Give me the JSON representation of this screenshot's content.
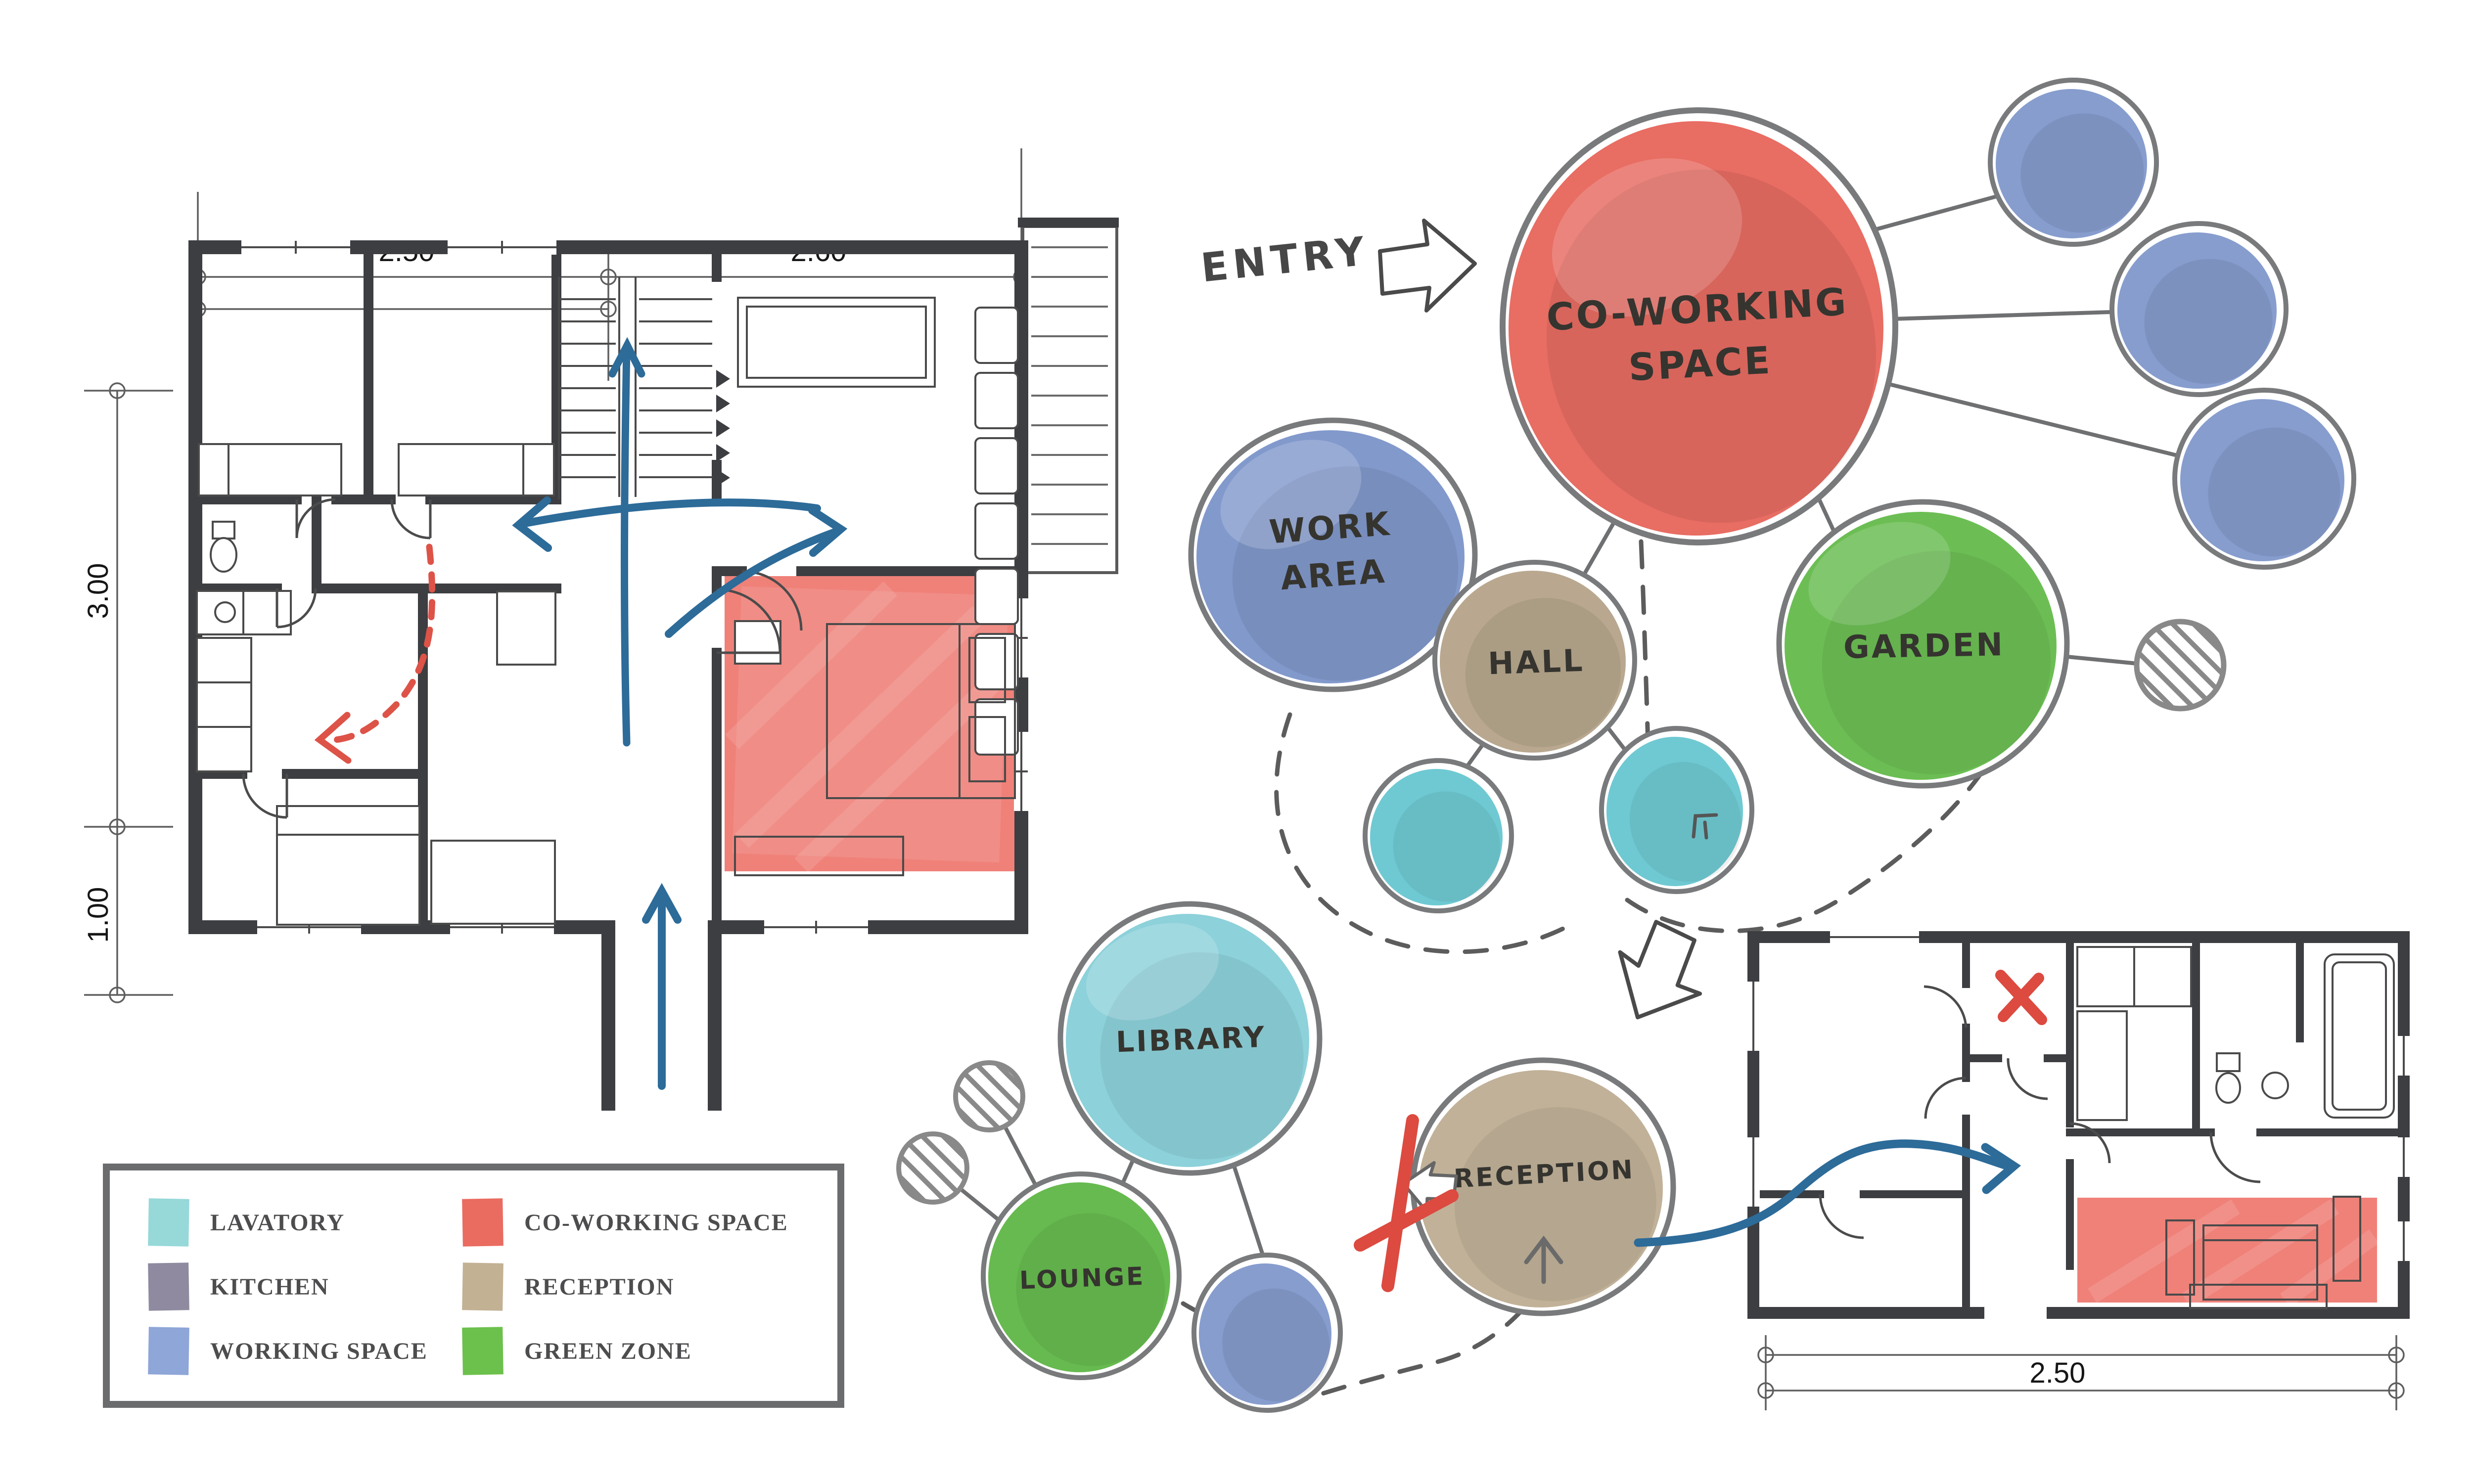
{
  "diagram": {
    "entry_label": "ENTRY",
    "colors": {
      "wall": "#3c3e41",
      "blue_arrow": "#2d6b99",
      "red_accent": "#dd5348",
      "bubble_ring": "#797a7c",
      "connector": "#6f7072",
      "dashed_line": "#5c5c5c"
    }
  },
  "legend": {
    "items": [
      {
        "label": "LAVATORY",
        "color": "#97d8d9"
      },
      {
        "label": "KITCHEN",
        "color": "#8f8aa0"
      },
      {
        "label": "WORKING SPACE",
        "color": "#8ea6d8"
      },
      {
        "label": "CO-WORKING SPACE",
        "color": "#ea6b60"
      },
      {
        "label": "RECEPTION",
        "color": "#c3b194"
      },
      {
        "label": "GREEN ZONE",
        "color": "#6cc04c"
      }
    ]
  },
  "bubbles": {
    "coworking": {
      "label_line1": "CO-WORKING",
      "label_line2": "SPACE",
      "color": "#e7655b"
    },
    "work_area": {
      "label_line1": "WORK",
      "label_line2": "AREA",
      "color": "#7b93c9"
    },
    "hall": {
      "label": "HALL",
      "color": "#b5a389"
    },
    "garden": {
      "label": "GARDEN",
      "color": "#64bb4b"
    },
    "library": {
      "label": "LIBRARY",
      "color": "#87cfd8"
    },
    "lounge": {
      "label": "LOUNGE",
      "color": "#5fb646"
    },
    "reception": {
      "label": "RECEPTION",
      "color": "#bead92"
    },
    "lavatory_small_color": "#67c6d0",
    "working_small_color": "#8198cb"
  },
  "floorplan_main": {
    "dim_top_left": "2.50",
    "dim_top_right": "2.60",
    "dim_left_upper": "3.00",
    "dim_left_lower": "1.00"
  },
  "floorplan_small": {
    "dim_bottom": "2.50"
  }
}
